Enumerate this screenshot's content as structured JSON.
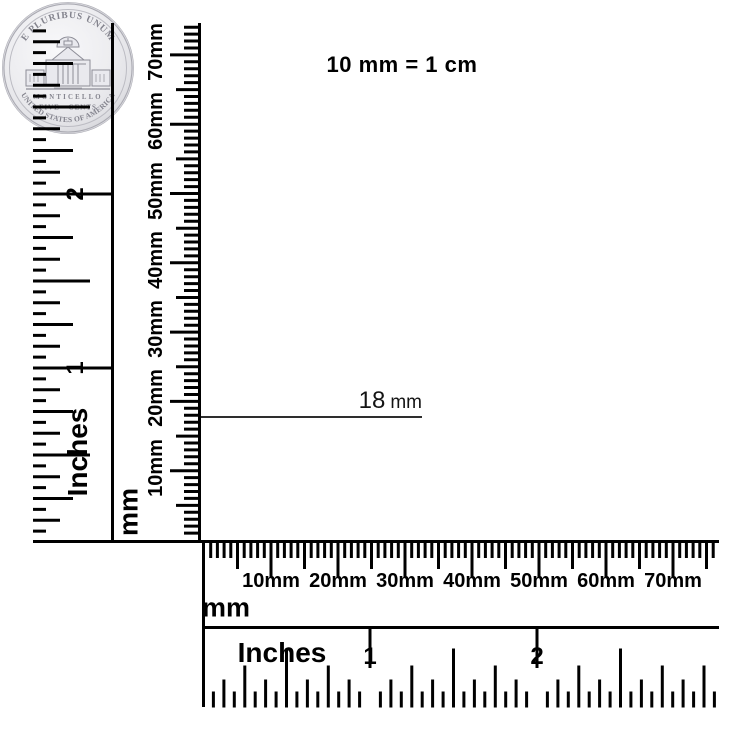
{
  "note": {
    "text": "10 mm = 1 cm"
  },
  "annotation": {
    "value": "18",
    "unit": "mm"
  },
  "rulers": {
    "left_inches": {
      "unit_label": "Inches",
      "numbers": [
        "1",
        "2"
      ]
    },
    "left_mm": {
      "unit_label": "mm",
      "tick_labels": [
        "10mm",
        "20mm",
        "30mm",
        "40mm",
        "50mm",
        "60mm",
        "70mm"
      ]
    },
    "bottom_mm": {
      "unit_label": "mm",
      "tick_labels": [
        "10mm",
        "20mm",
        "30mm",
        "40mm",
        "50mm",
        "60mm",
        "70mm"
      ]
    },
    "bottom_inches": {
      "unit_label": "Inches",
      "numbers": [
        "1",
        "2"
      ]
    }
  },
  "coin": {
    "top_legend": "E PLURIBUS UNUM",
    "building_label": "MONTICELLO",
    "denomination": "FIVE CENTS",
    "bottom_legend": "UNITED STATES OF AMERICA"
  },
  "colors": {
    "ink": "#000000",
    "annotation_line": "#2e2e2e",
    "rose_gold": "#d99b85",
    "rose_gold_light": "#f3cebf",
    "rose_gold_dark": "#b67a63",
    "pave_silver": "#efeff1",
    "pearl": "#ebebed",
    "coin_face": "#ededf0",
    "coin_engraving": "#83838d"
  }
}
